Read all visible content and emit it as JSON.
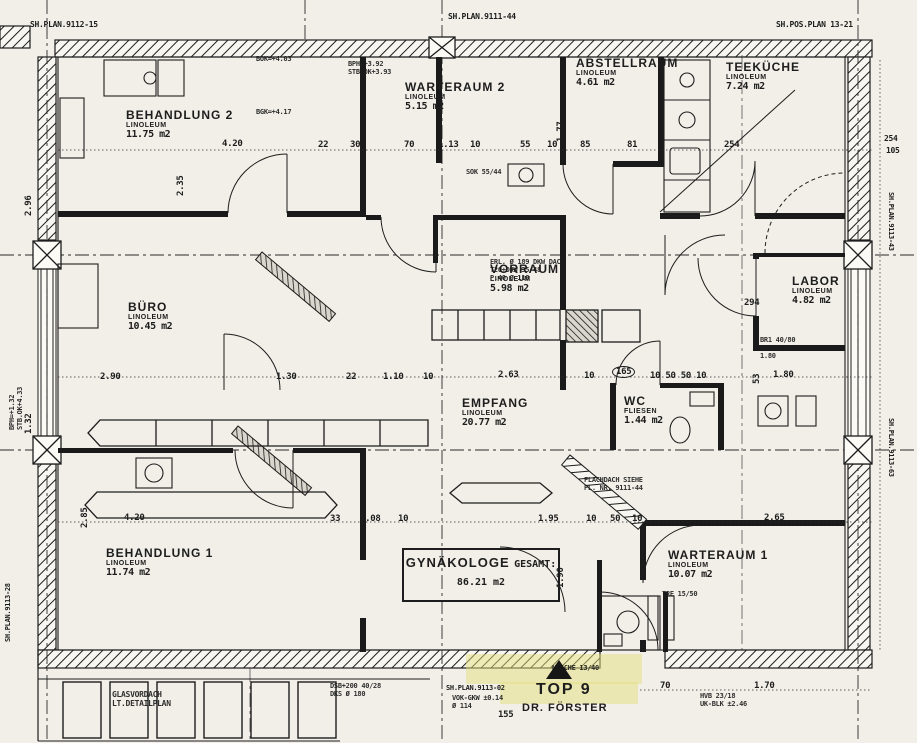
{
  "colors": {
    "paper": "#f1efe8",
    "ink": "#1d1d1d",
    "highlight": "#e6df7e"
  },
  "rooms": {
    "behandlung2": {
      "name": "BEHANDLUNG 2",
      "floor": "LINOLEUM",
      "area": "11.75 m2"
    },
    "warteraum2": {
      "name": "WARTERAUM 2",
      "floor": "LINOLEUM",
      "area": "5.15 m2"
    },
    "abstellraum": {
      "name": "ABSTELLRAUM",
      "floor": "LINOLEUM",
      "area": "4.61 m2"
    },
    "teekueche": {
      "name": "TEEKÜCHE",
      "floor": "LINOLEUM",
      "area": "7.24 m2"
    },
    "buero": {
      "name": "BÜRO",
      "floor": "LINOLEUM",
      "area": "10.45 m2"
    },
    "vorraum": {
      "name": "VORRAUM",
      "floor": "LINOLEUM",
      "area": "5.98 m2"
    },
    "labor": {
      "name": "LABOR",
      "floor": "LINOLEUM",
      "area": "4.82 m2"
    },
    "empfang": {
      "name": "EMPFANG",
      "floor": "LINOLEUM",
      "area": "20.77 m2"
    },
    "wc": {
      "name": "WC",
      "floor": "FLIESEN",
      "area": "1.44 m2"
    },
    "behandlung1": {
      "name": "BEHANDLUNG 1",
      "floor": "LINOLEUM",
      "area": "11.74 m2"
    },
    "warteraum1": {
      "name": "WARTERAUM 1",
      "floor": "LINOLEUM",
      "area": "10.07 m2"
    },
    "gynaekologe": {
      "name": "GYNÄKOLOGE",
      "total": "GESAMT: 86.21 m2"
    }
  },
  "unit_marker": {
    "top": "TOP 9",
    "tenant": "DR. FÖRSTER"
  },
  "labels": [
    {
      "t": "SH.PLAN.9112-15",
      "x": 30,
      "y": 20,
      "fs": 8,
      "n": "plan-ref"
    },
    {
      "t": "SH.PLAN.9111-44",
      "x": 448,
      "y": 12,
      "fs": 8,
      "n": "plan-ref"
    },
    {
      "t": "SH.POS.PLAN 13-21",
      "x": 776,
      "y": 20,
      "fs": 8,
      "n": "plan-ref"
    },
    {
      "t": "SH.PLAN.9113-43",
      "x": 895,
      "y": 192,
      "fs": 7,
      "r": 90,
      "n": "plan-ref"
    },
    {
      "t": "SH.PLAN.9113-63",
      "x": 895,
      "y": 418,
      "fs": 7,
      "r": 90,
      "n": "plan-ref"
    },
    {
      "t": "SH.PLAN.9113-28",
      "x": 4,
      "y": 642,
      "fs": 7,
      "r": -90,
      "n": "plan-ref"
    },
    {
      "t": "SH.PLAN.9113-02",
      "x": 446,
      "y": 684,
      "fs": 7,
      "n": "plan-ref"
    },
    {
      "t": "BOK=+4.03",
      "x": 256,
      "y": 55,
      "fs": 7,
      "n": "level-note",
      "cls": "note"
    },
    {
      "t": "BPH=+3.92\nSTB.OK+3.93",
      "x": 348,
      "y": 60,
      "fs": 7,
      "n": "level-note",
      "cls": "note"
    },
    {
      "t": "BGK=+4.17",
      "x": 256,
      "y": 108,
      "fs": 7,
      "n": "level-note",
      "cls": "note"
    },
    {
      "t": "SOK 55/44",
      "x": 466,
      "y": 168,
      "fs": 7,
      "n": "note",
      "cls": "note"
    },
    {
      "t": "ERL. Ø 189 DKW DACH\nT20+DKW 35/48\nP.40 Ø 118",
      "x": 490,
      "y": 258,
      "fs": 7,
      "n": "note",
      "cls": "note"
    },
    {
      "t": "FLACHDACH SIEHE\nPL. NR. 9111-44",
      "x": 584,
      "y": 476,
      "fs": 7,
      "n": "note",
      "cls": "note"
    },
    {
      "t": "BR1 40/80\nBK +0.97\n1.80",
      "x": 760,
      "y": 336,
      "fs": 7,
      "n": "note",
      "cls": "note"
    },
    {
      "t": "BPH=+1.32\nSTB.OK+4.33",
      "x": 8,
      "y": 430,
      "fs": 7,
      "r": -90,
      "n": "note",
      "cls": "note"
    },
    {
      "t": "TRE 15/50",
      "x": 662,
      "y": 590,
      "fs": 7,
      "n": "note",
      "cls": "note"
    },
    {
      "t": "DSB+200 40/28\nDKS Ø 180",
      "x": 330,
      "y": 682,
      "fs": 7,
      "n": "note",
      "cls": "note"
    },
    {
      "t": "VOK-GKW ±0.14\nØ 114",
      "x": 452,
      "y": 694,
      "fs": 7,
      "n": "note",
      "cls": "note"
    },
    {
      "t": "NISCHE 13/40",
      "x": 552,
      "y": 664,
      "fs": 7,
      "n": "note",
      "cls": "note"
    },
    {
      "t": "HVB 23/18\nUK-BLK ±2.46",
      "x": 700,
      "y": 692,
      "fs": 7,
      "n": "note",
      "cls": "note"
    },
    {
      "t": "GLASVORDACH\nLT.DETAILPLAN",
      "x": 112,
      "y": 690,
      "fs": 8,
      "n": "canopy-label",
      "cls": "note"
    },
    {
      "t": "4.20",
      "x": 222,
      "y": 139
    },
    {
      "t": "22",
      "x": 318,
      "y": 140
    },
    {
      "t": "30",
      "x": 350,
      "y": 140
    },
    {
      "t": "70",
      "x": 404,
      "y": 140
    },
    {
      "t": "1.13",
      "x": 438,
      "y": 140
    },
    {
      "t": "10",
      "x": 470,
      "y": 140
    },
    {
      "t": "55",
      "x": 520,
      "y": 140
    },
    {
      "t": "10",
      "x": 547,
      "y": 140
    },
    {
      "t": "85",
      "x": 580,
      "y": 140
    },
    {
      "t": "81",
      "x": 627,
      "y": 140
    },
    {
      "t": "254",
      "x": 724,
      "y": 140
    },
    {
      "t": "254",
      "x": 884,
      "y": 134,
      "fs": 8
    },
    {
      "t": "105",
      "x": 886,
      "y": 146,
      "fs": 8
    },
    {
      "t": "2.35",
      "x": 176,
      "y": 196,
      "r": -90
    },
    {
      "t": "1.77",
      "x": 556,
      "y": 142,
      "r": -90
    },
    {
      "t": "2.96",
      "x": 24,
      "y": 216,
      "r": -90
    },
    {
      "t": "2.90",
      "x": 100,
      "y": 372
    },
    {
      "t": "1.30",
      "x": 276,
      "y": 372
    },
    {
      "t": "22",
      "x": 346,
      "y": 372
    },
    {
      "t": "1.10",
      "x": 383,
      "y": 372
    },
    {
      "t": "10",
      "x": 423,
      "y": 372
    },
    {
      "t": "2.63",
      "x": 498,
      "y": 370
    },
    {
      "t": "10",
      "x": 584,
      "y": 371
    },
    {
      "t": "165",
      "x": 612,
      "y": 366,
      "cls": "oval"
    },
    {
      "t": "10 50 50 10",
      "x": 650,
      "y": 371
    },
    {
      "t": "1.80",
      "x": 773,
      "y": 370
    },
    {
      "t": "294",
      "x": 744,
      "y": 298
    },
    {
      "t": "53",
      "x": 752,
      "y": 384,
      "r": -90
    },
    {
      "t": "1.32",
      "x": 24,
      "y": 434,
      "r": -90
    },
    {
      "t": "2.85",
      "x": 80,
      "y": 528,
      "r": -90
    },
    {
      "t": "4.20",
      "x": 124,
      "y": 513
    },
    {
      "t": "33",
      "x": 330,
      "y": 514
    },
    {
      "t": "1.08",
      "x": 360,
      "y": 514
    },
    {
      "t": "10",
      "x": 398,
      "y": 514
    },
    {
      "t": "1.95",
      "x": 538,
      "y": 514
    },
    {
      "t": "10",
      "x": 586,
      "y": 514
    },
    {
      "t": "50",
      "x": 610,
      "y": 514
    },
    {
      "t": "10",
      "x": 632,
      "y": 514
    },
    {
      "t": "2.65",
      "x": 764,
      "y": 513
    },
    {
      "t": "1.90",
      "x": 556,
      "y": 588,
      "r": -90
    },
    {
      "t": "155",
      "x": 498,
      "y": 710
    },
    {
      "t": "70",
      "x": 660,
      "y": 681
    },
    {
      "t": "1.70",
      "x": 754,
      "y": 681
    }
  ]
}
